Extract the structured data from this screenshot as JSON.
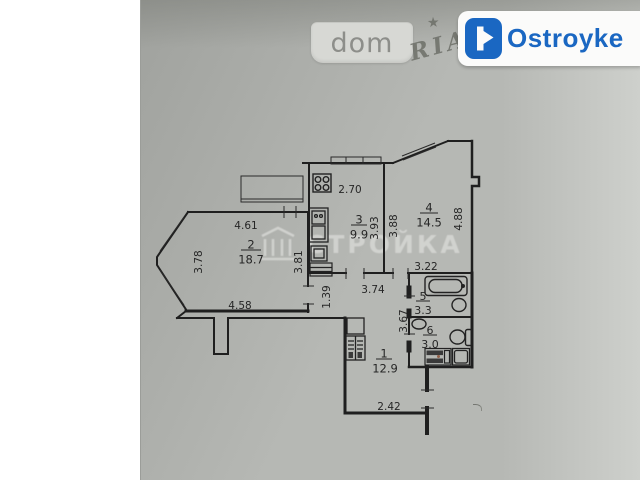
{
  "watermarks": {
    "dom_label": "dom",
    "ria_label": "RIA",
    "ria_star": "★",
    "brand_label": "Ostroyke",
    "center_text": "СТРОЙКА"
  },
  "colors": {
    "brand_blue": "#1a67c2",
    "photo_gray": "#b6b8b4",
    "wall_line": "#1f1f1f"
  },
  "plan": {
    "rooms": [
      {
        "num": "2",
        "area": "18.7"
      },
      {
        "num": "3",
        "area": "9.9"
      },
      {
        "num": "4",
        "area": "14.5"
      },
      {
        "num": "5",
        "area": "3.3"
      },
      {
        "num": "6",
        "area": "3.0"
      },
      {
        "num": "1",
        "area": "12.9"
      }
    ],
    "dims": {
      "d461": "4.61",
      "d378": "3.78",
      "d381": "3.81",
      "d458": "4.58",
      "d270": "2.70",
      "d393": "3.93",
      "d388": "3.88",
      "d488": "4.88",
      "d322": "3.22",
      "d139": "1.39",
      "d374": "3.74",
      "d367": "3.67",
      "d242": "2.42"
    }
  }
}
